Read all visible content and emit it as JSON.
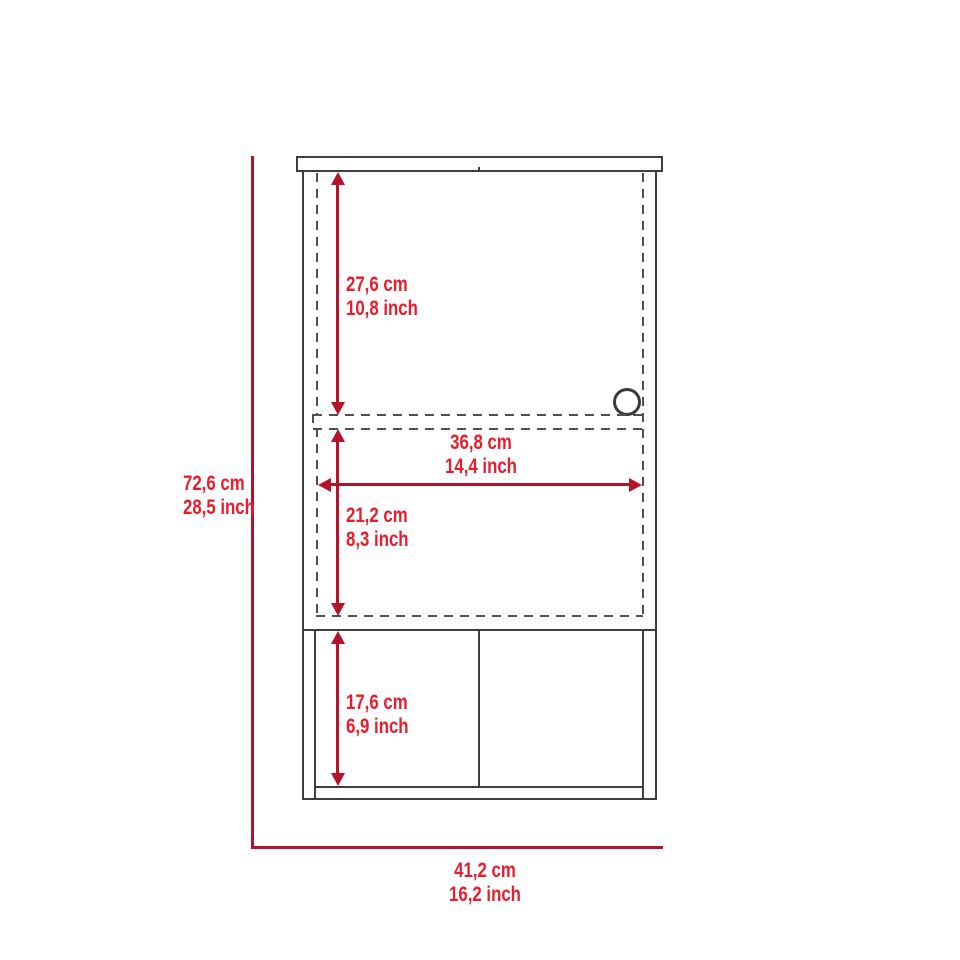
{
  "diagram": {
    "subject": "wall-cabinet-dimension-drawing",
    "labels": {
      "overall_height_cm": "72,6 cm",
      "overall_height_in": "28,5 inch",
      "overall_width_cm": "41,2 cm",
      "overall_width_in": "16,2 inch",
      "upper_section_height_cm": "27,6 cm",
      "upper_section_height_in": "10,8 inch",
      "interior_width_cm": "36,8 cm",
      "interior_width_in": "14,4 inch",
      "middle_section_height_cm": "21,2 cm",
      "middle_section_height_in": "8,3 inch",
      "lower_section_height_cm": "17,6 cm",
      "lower_section_height_in": "6,9 inch"
    },
    "colors": {
      "dimension_line": "#B5122B",
      "dimension_text": "#E81C2C",
      "outline": "#3E3E3E",
      "dashed_line": "#4F4F4F",
      "background": "#FFFFFF"
    }
  }
}
